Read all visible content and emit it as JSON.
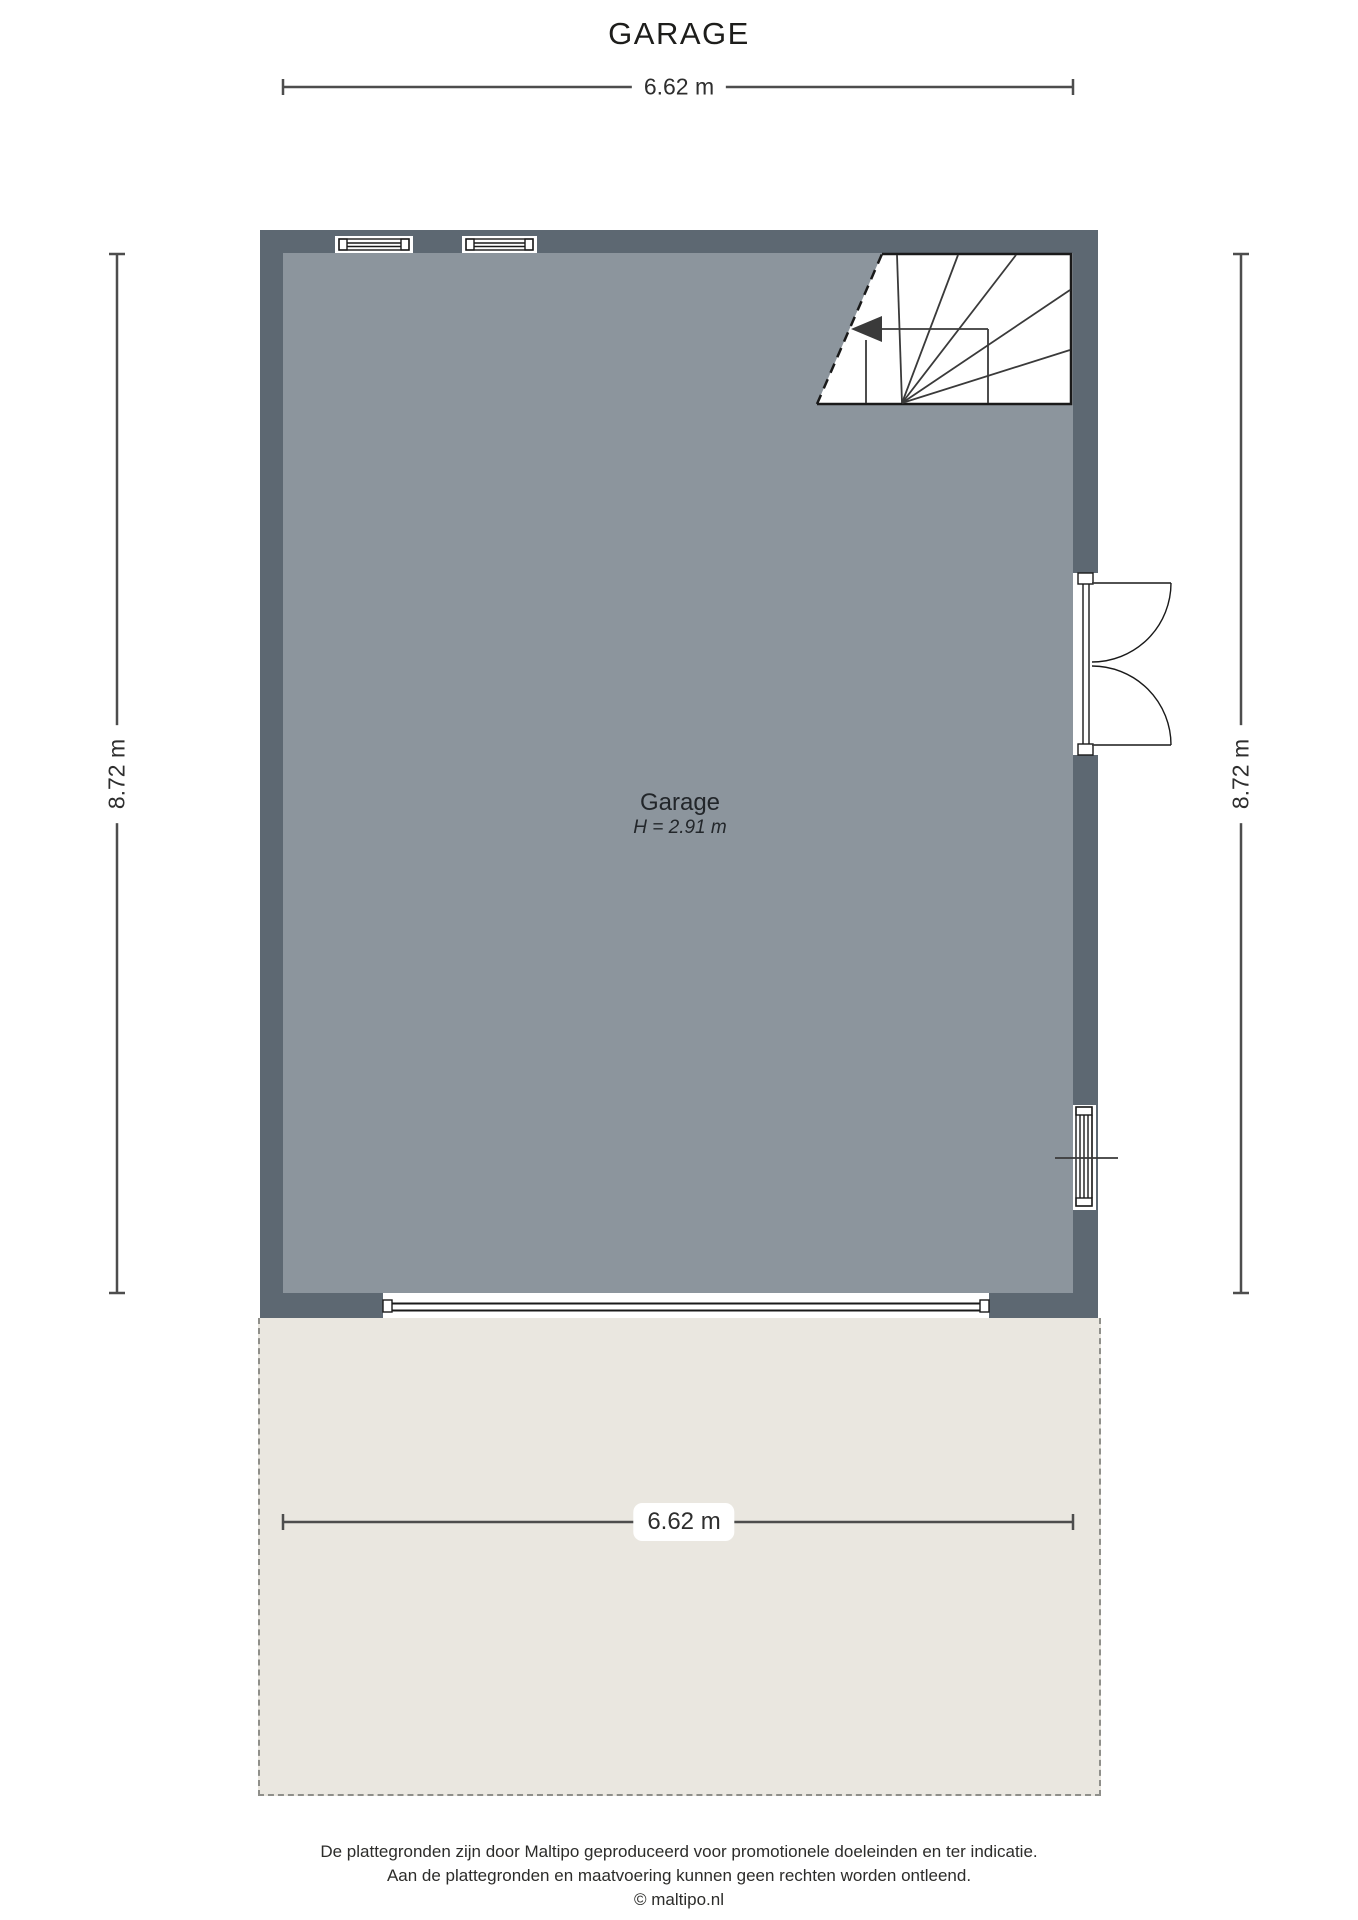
{
  "title": "GARAGE",
  "room": {
    "name": "Garage",
    "height": "H = 2.91 m"
  },
  "dimensions": {
    "width_top": "6.62 m",
    "width_bottom": "6.62 m",
    "height_left": "8.72 m",
    "height_right": "8.72 m"
  },
  "footer": {
    "line1": "De plattegronden zijn door Maltipo geproduceerd voor promotionele doeleinden en ter indicatie.",
    "line2": "Aan de plattegronden en maatvoering kunnen geen rechten worden ontleend.",
    "line3": "© maltipo.nl"
  },
  "colors": {
    "wall": "#5d6872",
    "floor": "#8c959d",
    "terrace": "#eae7e0",
    "terrace_border": "#8f8f8a",
    "dimension_line": "#4d4d4d",
    "linework": "#3a3a3a",
    "outline": "#1a1a1a",
    "text": "#1d1d1b"
  }
}
